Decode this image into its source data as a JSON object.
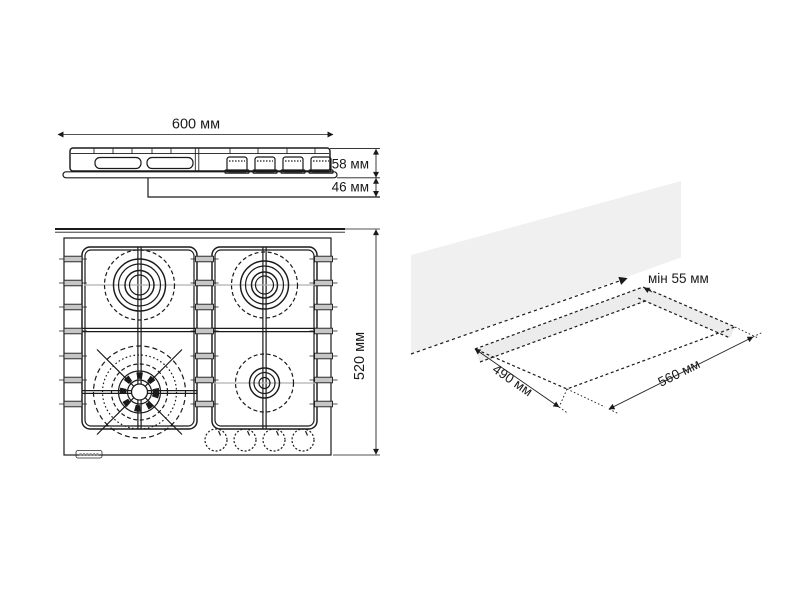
{
  "side_view": {
    "width": "600 мм",
    "height_above_counter": "58 мм",
    "height_below_counter": "46 мм"
  },
  "top_view": {
    "depth": "520 мм",
    "burner_count": 4,
    "knob_count": 4
  },
  "cutout": {
    "min_wall_clearance": "мін 55 мм",
    "cutout_depth": "490 мм",
    "cutout_width": "560 мм"
  },
  "colors": {
    "line": "#1a1a1a",
    "wall_fill": "#f0f0f0",
    "overlap_band_fill": "#ececec",
    "grate_tab_fill": "#c6c6c6",
    "center_line_gray": "#b0b0b0",
    "background": "#ffffff"
  }
}
